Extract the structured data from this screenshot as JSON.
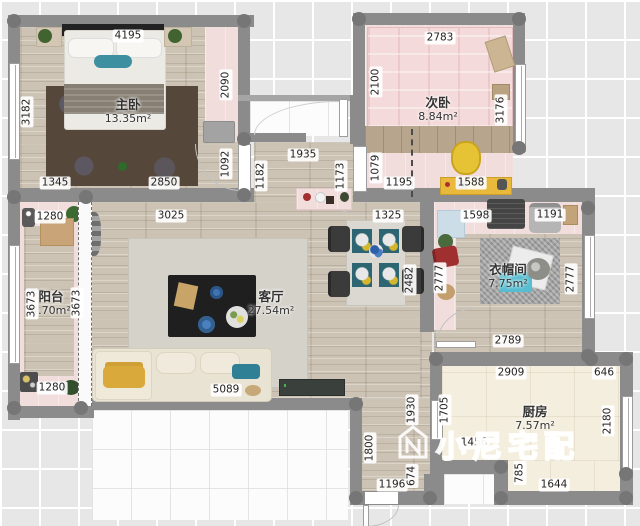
{
  "watermark": {
    "text": "小尼宅配",
    "logo": "house-n-logo"
  },
  "palette": {
    "wall": "#8b8b8b",
    "wood_floor": "#ccc3b4",
    "pink_floor": "#f2dddd",
    "kitchen_floor": "#f4eedf",
    "accent_teal": "#3e8fa0",
    "accent_yellow": "#e6c235"
  },
  "rooms": [
    {
      "id": "master-bedroom",
      "name": "主卧",
      "area": "13.35m²",
      "x": 128,
      "y": 98
    },
    {
      "id": "second-bedroom",
      "name": "次卧",
      "area": "8.84m²",
      "x": 438,
      "y": 96
    },
    {
      "id": "living-room",
      "name": "客厅",
      "area": "27.54m²",
      "x": 271,
      "y": 290
    },
    {
      "id": "balcony",
      "name": "阳台",
      "area": "4.70m²",
      "x": 51,
      "y": 290
    },
    {
      "id": "cloakroom",
      "name": "衣帽间",
      "area": "7.75m²",
      "x": 508,
      "y": 263
    },
    {
      "id": "kitchen",
      "name": "厨房",
      "area": "7.57m²",
      "x": 535,
      "y": 405
    }
  ],
  "dimensions": [
    {
      "id": "master-width-top",
      "value": "4195",
      "x": 128,
      "y": 36,
      "o": "h"
    },
    {
      "id": "master-height-left",
      "value": "3182",
      "x": 27,
      "y": 112,
      "o": "v"
    },
    {
      "id": "master-closet-height",
      "value": "2090",
      "x": 226,
      "y": 85,
      "o": "v"
    },
    {
      "id": "master-bottom-left",
      "value": "1345",
      "x": 55,
      "y": 183,
      "o": "h"
    },
    {
      "id": "master-bottom-right",
      "value": "2850",
      "x": 164,
      "y": 183,
      "o": "h"
    },
    {
      "id": "master-door",
      "value": "1092",
      "x": 226,
      "y": 164,
      "o": "v"
    },
    {
      "id": "hall-top-width",
      "value": "1935",
      "x": 303,
      "y": 155,
      "o": "h"
    },
    {
      "id": "hall-1182",
      "value": "1182",
      "x": 261,
      "y": 176,
      "o": "v"
    },
    {
      "id": "hall-1173",
      "value": "1173",
      "x": 341,
      "y": 176,
      "o": "v"
    },
    {
      "id": "second-door-height",
      "value": "1079",
      "x": 376,
      "y": 168,
      "o": "v"
    },
    {
      "id": "second-width-top",
      "value": "2783",
      "x": 440,
      "y": 38,
      "o": "h"
    },
    {
      "id": "second-height-left",
      "value": "2100",
      "x": 376,
      "y": 82,
      "o": "v"
    },
    {
      "id": "second-height-right",
      "value": "3176",
      "x": 501,
      "y": 110,
      "o": "v"
    },
    {
      "id": "second-bottom-left",
      "value": "1195",
      "x": 399,
      "y": 183,
      "o": "h"
    },
    {
      "id": "second-desk",
      "value": "1588",
      "x": 471,
      "y": 183,
      "o": "h"
    },
    {
      "id": "dining-width",
      "value": "1325",
      "x": 388,
      "y": 216,
      "o": "h"
    },
    {
      "id": "dining-height",
      "value": "2482",
      "x": 410,
      "y": 280,
      "o": "v"
    },
    {
      "id": "living-width-top",
      "value": "3025",
      "x": 171,
      "y": 216,
      "o": "h"
    },
    {
      "id": "sofa-wall",
      "value": "5089",
      "x": 226,
      "y": 390,
      "o": "h"
    },
    {
      "id": "balcony-width-top",
      "value": "1280",
      "x": 50,
      "y": 217,
      "o": "h"
    },
    {
      "id": "balcony-height-left",
      "value": "3673",
      "x": 32,
      "y": 304,
      "o": "v"
    },
    {
      "id": "balcony-height-right",
      "value": "3673",
      "x": 77,
      "y": 303,
      "o": "v"
    },
    {
      "id": "balcony-width-bottom",
      "value": "1280",
      "x": 52,
      "y": 388,
      "o": "h"
    },
    {
      "id": "cloak-top-left",
      "value": "1598",
      "x": 476,
      "y": 216,
      "o": "h"
    },
    {
      "id": "cloak-top-right",
      "value": "1191",
      "x": 550,
      "y": 215,
      "o": "h"
    },
    {
      "id": "cloak-height-left",
      "value": "2777",
      "x": 440,
      "y": 278,
      "o": "v"
    },
    {
      "id": "cloak-height-right",
      "value": "2777",
      "x": 571,
      "y": 279,
      "o": "v"
    },
    {
      "id": "cloak-width-bottom",
      "value": "2789",
      "x": 508,
      "y": 341,
      "o": "h"
    },
    {
      "id": "kitchen-width-top",
      "value": "2909",
      "x": 511,
      "y": 373,
      "o": "h"
    },
    {
      "id": "kitchen-top-right",
      "value": "646",
      "x": 604,
      "y": 373,
      "o": "h"
    },
    {
      "id": "kitchen-height-left",
      "value": "1705",
      "x": 445,
      "y": 410,
      "o": "v"
    },
    {
      "id": "kitchen-mid-width",
      "value": "1456",
      "x": 474,
      "y": 443,
      "o": "h"
    },
    {
      "id": "kitchen-height-right",
      "value": "2180",
      "x": 608,
      "y": 421,
      "o": "v"
    },
    {
      "id": "kitchen-notch",
      "value": "785",
      "x": 520,
      "y": 473,
      "o": "v"
    },
    {
      "id": "kitchen-width-bottom",
      "value": "1644",
      "x": 554,
      "y": 485,
      "o": "h"
    },
    {
      "id": "hall-1930",
      "value": "1930",
      "x": 412,
      "y": 410,
      "o": "v"
    },
    {
      "id": "hall-1800",
      "value": "1800",
      "x": 370,
      "y": 448,
      "o": "v"
    },
    {
      "id": "entry-width",
      "value": "1196",
      "x": 392,
      "y": 485,
      "o": "h"
    },
    {
      "id": "entry-674",
      "value": "674",
      "x": 412,
      "y": 476,
      "o": "v"
    }
  ]
}
